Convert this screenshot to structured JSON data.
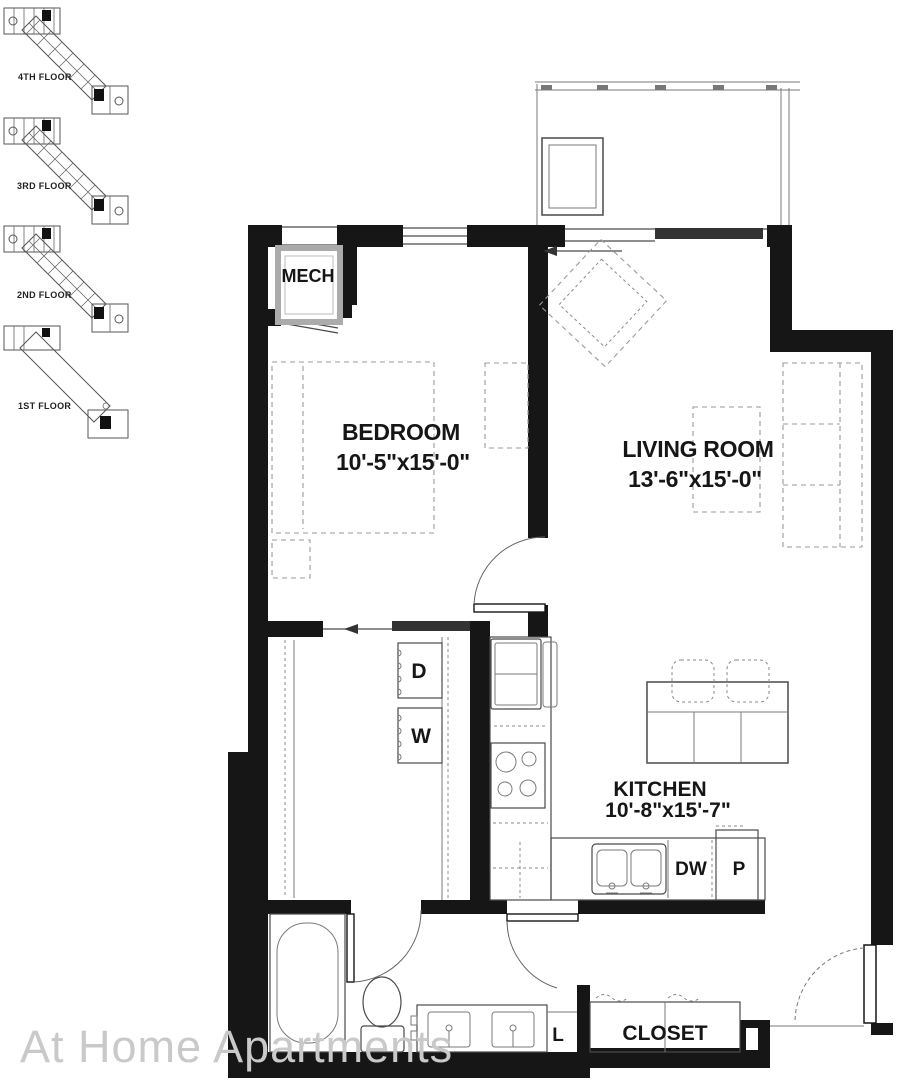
{
  "watermark": "At Home Apartments",
  "keyplan": {
    "floors": [
      {
        "label": "4TH FLOOR"
      },
      {
        "label": "3RD FLOOR"
      },
      {
        "label": "2ND FLOOR"
      },
      {
        "label": "1ST FLOOR"
      }
    ]
  },
  "rooms": {
    "mech": {
      "label": "MECH"
    },
    "bedroom": {
      "label": "BEDROOM",
      "dims": "10'-5\"x15'-0\""
    },
    "living_room": {
      "label": "LIVING ROOM",
      "dims": "13'-6\"x15'-0\""
    },
    "kitchen": {
      "label": "KITCHEN",
      "dims": "10'-8\"x15'-7\""
    },
    "closet": {
      "label": "CLOSET"
    }
  },
  "appliances": {
    "dryer": "D",
    "washer": "W",
    "dishwasher": "DW",
    "pantry": "P",
    "linen": "L"
  },
  "colors": {
    "wall": "#161616",
    "thin_line": "#4a4a4a",
    "dash": "#9a9a9a",
    "watermark": "#c9c9c9",
    "background": "#ffffff"
  }
}
